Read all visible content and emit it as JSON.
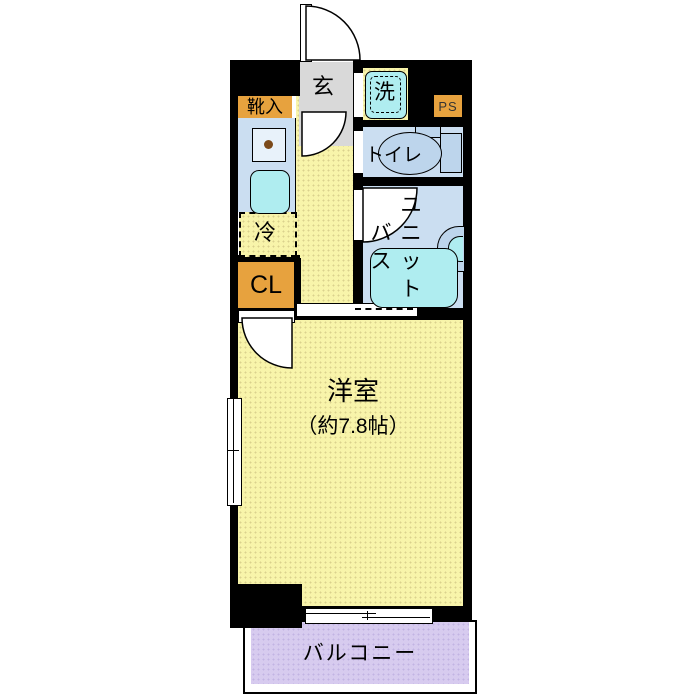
{
  "plan_title": "1K apartment floor plan",
  "colors": {
    "wall": "#000000",
    "room_yellow": "#F8F4AA",
    "water_room_blue": "#CBDEF1",
    "fixture_cyan": "#AFEDF0",
    "storage_orange": "#E7A23E",
    "genkan_gray": "#D9D9D9",
    "balcony_lavender": "#D7CBEF",
    "background": "#FFFFFF"
  },
  "rooms": {
    "genkan": {
      "label": "玄"
    },
    "washer": {
      "label": "洗"
    },
    "ps": {
      "label": "PS"
    },
    "shoe_cabinet": {
      "label": "靴入"
    },
    "toilet": {
      "label": "トイレ"
    },
    "fridge": {
      "label": "冷"
    },
    "closet": {
      "label": "CL"
    },
    "unit_bath": {
      "label": "ユニットバス",
      "grid": [
        [
          "",
          "ユ"
        ],
        [
          "バ",
          "ニ"
        ],
        [
          "ス",
          "ッ"
        ],
        [
          "",
          "ト"
        ]
      ]
    },
    "main_room": {
      "label": "洋室",
      "size": "（約7.8帖）"
    },
    "balcony": {
      "label": "バルコニー"
    }
  }
}
